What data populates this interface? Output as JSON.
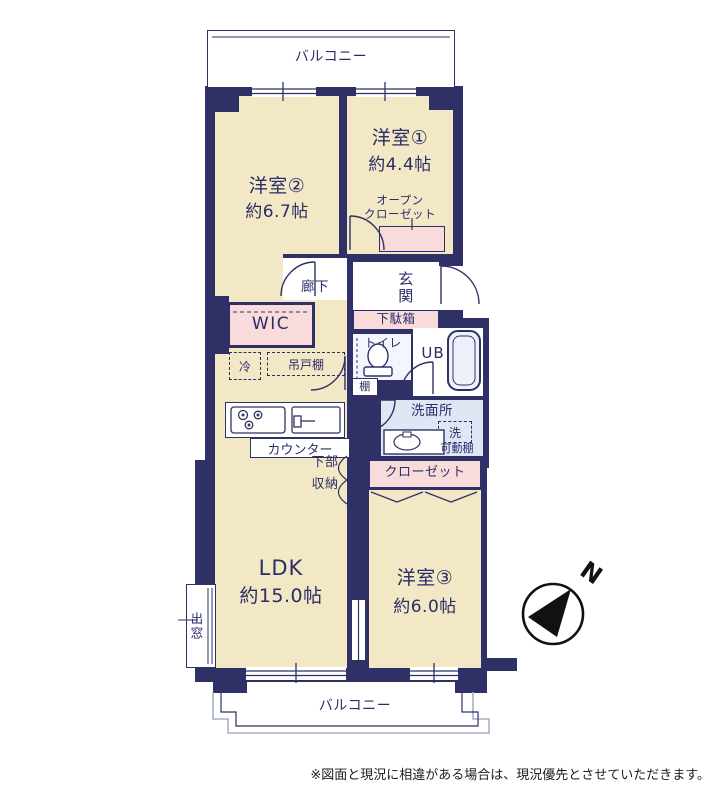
{
  "colors": {
    "wall": "#2f3166",
    "room_fill": "#f2e8c6",
    "closet_fill": "#f8dbda",
    "wet_area_fill": "#dfe7f4",
    "text": "#2b2d66",
    "balcony_outline_outer": "#a9b1c9",
    "compass": "#111111"
  },
  "balconies": {
    "top_label": "バルコニー",
    "bottom_label": "バルコニー"
  },
  "rooms": {
    "room1": {
      "name": "洋室①",
      "size": "約4.4帖"
    },
    "room2": {
      "name": "洋室②",
      "size": "約6.7帖"
    },
    "room3": {
      "name": "洋室③",
      "size": "約6.0帖"
    },
    "ldk": {
      "name": "LDK",
      "size": "約15.0帖"
    }
  },
  "labels": {
    "open_closet_line1": "オープン",
    "open_closet_line2": "クローゼット",
    "hallway": "廊下",
    "entrance": "玄関",
    "shoe_cabinet": "下駄箱",
    "wic": "WIC",
    "toilet": "トイレ",
    "unit_bath": "UB",
    "shelf": "棚",
    "washroom": "洗面所",
    "washer": "洗",
    "movable_shelf": "可動棚",
    "refrigerator": "冷",
    "hanging_cupboard": "吊戸棚",
    "counter": "カウンター",
    "lower_storage_line1": "下部",
    "lower_storage_line2": "収納",
    "closet": "クローゼット",
    "bay_window": "出窓"
  },
  "compass": {
    "north": "N"
  },
  "notes": {
    "disclaimer": "※図面と現況に相違がある場合は、現況優先とさせていただきます。"
  }
}
